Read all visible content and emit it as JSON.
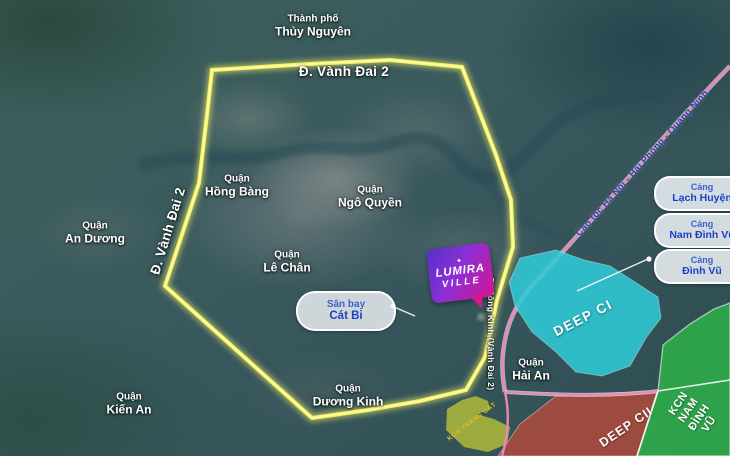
{
  "city_label": {
    "prefix": "Thành phố",
    "name": "Thủy Nguyên"
  },
  "roads": {
    "ring_top_label": "Đ. Vành Đai 2",
    "ring_left_label": "Đ. Vành Đai 2",
    "dong_kinh_label": "Đ. Đông Kinh (Vành Đai 2)",
    "highway_label": "Cao tốc Hà Nội - Hải Phòng - Quảng Ninh",
    "ring_color": "#f5f263",
    "highway_color": "#e988b8"
  },
  "districts": [
    {
      "prefix": "Quận",
      "name": "Hồng Bàng"
    },
    {
      "prefix": "Quận",
      "name": "An Dương"
    },
    {
      "prefix": "Quận",
      "name": "Ngô Quyền"
    },
    {
      "prefix": "Quận",
      "name": "Lê Chân"
    },
    {
      "prefix": "Quận",
      "name": "Kiến An"
    },
    {
      "prefix": "Quận",
      "name": "Dương Kinh"
    },
    {
      "prefix": "Quận",
      "name": "Hải An"
    }
  ],
  "zones": [
    {
      "name": "DEEP CI",
      "color": "#2fc9d6"
    },
    {
      "name": "DEEP CII",
      "color": "#b04a3c"
    },
    {
      "name": "KCN",
      "name2": "NAM ĐÌNH VŨ",
      "color": "#2fae4a"
    },
    {
      "name": "KCN TRÀNG CÁT",
      "color": "#a9b43b",
      "label_color": "#dcbb2c"
    }
  ],
  "airport_badge": {
    "prefix": "Sân bay",
    "name": "Cát Bi"
  },
  "port_badges": [
    {
      "prefix": "Cảng",
      "name": "Lạch Huyện"
    },
    {
      "prefix": "Cảng",
      "name": "Nam Đình Vũ"
    },
    {
      "prefix": "Cảng",
      "name": "Đình Vũ"
    }
  ],
  "logo": {
    "sparkle": "✦",
    "line1": "LUMIRA",
    "line2": "VILLE"
  }
}
